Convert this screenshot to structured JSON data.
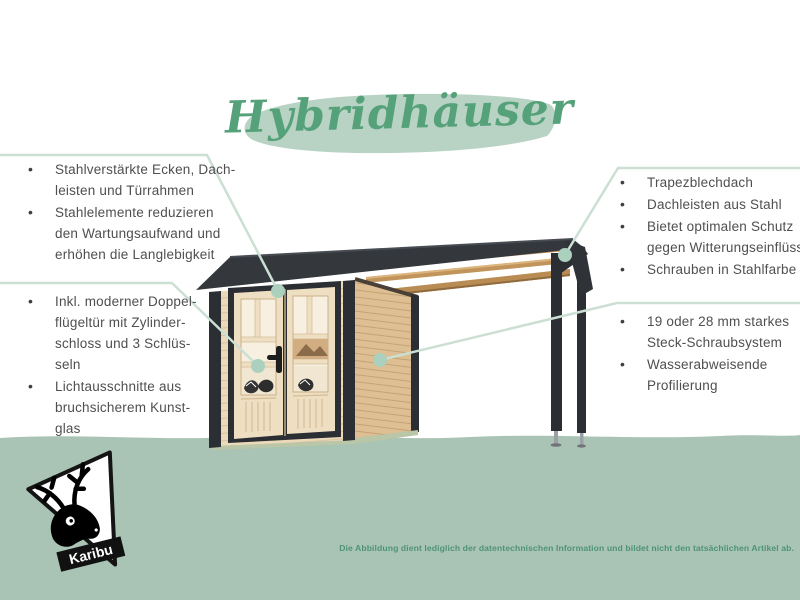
{
  "title": {
    "text": "Hybridhäuser"
  },
  "brand": {
    "name": "Karibu",
    "logo_icon": "deer-icon"
  },
  "feature_groups": {
    "top_left": {
      "items": [
        {
          "lines": [
            "Stahlverstärkte Ecken, Dach-",
            "leisten und Türrahmen"
          ]
        },
        {
          "lines": [
            "Stahlelemente reduzieren",
            "den Wartungsaufwand und",
            "erhöhen die Langlebigkeit"
          ]
        }
      ]
    },
    "bottom_left": {
      "items": [
        {
          "lines": [
            "Inkl. moderner Doppel-",
            "flügeltür mit Zylinder-",
            "schloss und 3 Schlüs-",
            "seln"
          ]
        },
        {
          "lines": [
            "Lichtausschnitte aus",
            "bruchsicherem Kunst-",
            "glas"
          ]
        }
      ]
    },
    "top_right": {
      "items": [
        {
          "lines": [
            "Trapezblechdach"
          ]
        },
        {
          "lines": [
            "Dachleisten aus Stahl"
          ]
        },
        {
          "lines": [
            "Bietet optimalen Schutz",
            "gegen Witterungseinflüsse"
          ]
        },
        {
          "lines": [
            "Schrauben in Stahlfarbe"
          ]
        }
      ]
    },
    "bottom_right": {
      "items": [
        {
          "lines": [
            "19 oder 28 mm starkes",
            "Steck-Schraubsystem"
          ]
        },
        {
          "lines": [
            "Wasserabweisende",
            "Profilierung"
          ]
        }
      ]
    }
  },
  "footer": {
    "disclaimer": "Die Abbildung dient lediglich der datentechnischen Information und bildet nicht den tatsächlichen Artikel ab."
  },
  "colors": {
    "ground_green": "#a9c4b4",
    "title_green": "#55a179",
    "title_brush": "#b8d3c4",
    "body_text": "#4f4f4f",
    "callout_line": "#cbdfd3",
    "callout_dot": "#abd0bd",
    "roof_anthracite": "#34383d",
    "wood_light": "#ecd9ba",
    "footer_green": "#4f9377"
  }
}
